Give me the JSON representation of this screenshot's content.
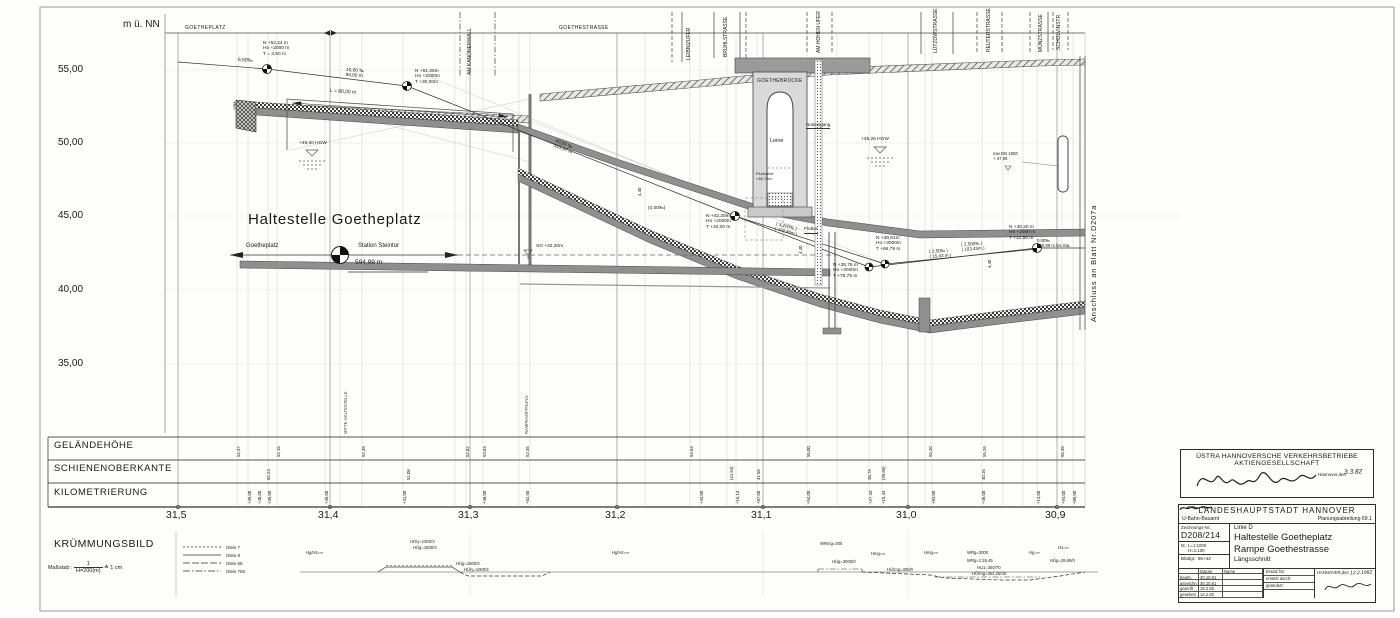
{
  "axis": {
    "unit": "m ü. NN",
    "elevations": [
      "55,00",
      "50,00",
      "45,00",
      "40,00",
      "35,00"
    ],
    "km": [
      "31,5",
      "31,4",
      "31,3",
      "31,2",
      "31,1",
      "31,0",
      "30,9"
    ]
  },
  "rows": {
    "gelaende": "GELÄNDEHÖHE",
    "schienen": "SCHIENENOBERKANTE",
    "kilometrierung": "KILOMETRIERUNG"
  },
  "streets": {
    "goetheplatz": "GOETHEPLATZ",
    "goethestrasse": "GOETHESTRASSE",
    "vertical": [
      {
        "name": "street-am-kanonenwall",
        "label": "AM KANONENWALL",
        "x": 468,
        "y": 75
      },
      {
        "name": "street-leibnizufer",
        "label": "LEIBNIZUFER",
        "x": 687,
        "y": 60
      },
      {
        "name": "street-bruehlstrasse",
        "label": "BRÜHLSTRASSE",
        "x": 724,
        "y": 57
      },
      {
        "name": "street-am-hohen-ufer",
        "label": "AM HOHEN UFER",
        "x": 817,
        "y": 53
      },
      {
        "name": "street-luetzowstrasse",
        "label": "LÜTZOWSTRASSE",
        "x": 934,
        "y": 53
      },
      {
        "name": "street-reuterstrasse",
        "label": "REUTERSTRASSE",
        "x": 987,
        "y": 52
      },
      {
        "name": "street-muenzstrasse",
        "label": "MÜNZSTRASSE",
        "x": 1039,
        "y": 52
      },
      {
        "name": "street-scholvinstr",
        "label": "SCHOLVINSTR.",
        "x": 1057,
        "y": 50
      }
    ]
  },
  "station": {
    "title": "Haltestelle  Goetheplatz",
    "dir_left": "Goetheplatz",
    "dir_right": "Station  Steintor",
    "length": "594,99 m",
    "mitte": "MITTE  HALTESTELLE",
    "rampe": "RAMPENÖFFNUNG"
  },
  "bridge": {
    "name": "GOETHEBRÜCKE",
    "river": "Leine",
    "flusssohle": [
      "Flußsohle",
      "=48,70m"
    ],
    "notausgang": "Notausgang",
    "fluttor": "Fluttor"
  },
  "connection": "Anschluss  an  Blatt  Nr.D207a",
  "annotations": [
    {
      "name": "gradient-point-1",
      "x": 263,
      "y": 41,
      "fs": 4.8,
      "lines": [
        "N  +52,24 m",
        "Ho +2000 m",
        "T  =  3,50 m"
      ]
    },
    {
      "name": "slope-650",
      "x": 238,
      "y": 58,
      "fs": 5,
      "rot": 3,
      "lines": [
        "6,50‰"
      ]
    },
    {
      "name": "slope-1000",
      "x": 346,
      "y": 68,
      "fs": 4.8,
      "rot": 4,
      "lines": [
        "10,00 ‰",
        "94,00 m"
      ]
    },
    {
      "name": "dim-l80",
      "x": 330,
      "y": 89,
      "fs": 5,
      "rot": 4,
      "lines": [
        "L = 80,00 m"
      ]
    },
    {
      "name": "gradient-point-2",
      "x": 415,
      "y": 69,
      "fs": 4.8,
      "lines": [
        "N  +51,30m",
        "Ho +2000m",
        "T  +30,00m"
      ]
    },
    {
      "name": "hgw-left",
      "x": 299,
      "y": 141,
      "fs": 4.8,
      "lines": [
        "+49,00  HGW"
      ]
    },
    {
      "name": "slope-4000",
      "x": 556,
      "y": 139,
      "fs": 4.8,
      "rot": 21,
      "lines": [
        "40,00 ‰",
        "313,97 m"
      ]
    },
    {
      "name": "slope-000-mid",
      "x": 648,
      "y": 206,
      "fs": 4.8,
      "lines": [
        "(0,00‰)"
      ]
    },
    {
      "name": "gradient-point-3",
      "x": 706,
      "y": 214,
      "fs": 4.8,
      "lines": [
        "N  +42,20m",
        "Ho +2000m",
        "T  +32,00 m"
      ]
    },
    {
      "name": "slope-3200",
      "x": 777,
      "y": 221,
      "fs": 4.5,
      "rot": 15,
      "lines": [
        "( 3,200‰ )",
        "( 102,80m )"
      ]
    },
    {
      "name": "so-level",
      "x": 536,
      "y": 244,
      "fs": 4.8,
      "lines": [
        "SO +42,20m"
      ]
    },
    {
      "name": "gradient-point-4",
      "x": 876,
      "y": 236,
      "fs": 4.8,
      "lines": [
        "N  +38,91m",
        "Ho +3000m",
        "T  +66,79 m"
      ]
    },
    {
      "name": "gradient-point-5",
      "x": 833,
      "y": 263,
      "fs": 4.8,
      "lines": [
        "N  +38,76 m",
        "Ho +3000m",
        "T  +76,75 m"
      ]
    },
    {
      "name": "slope-250",
      "x": 929,
      "y": 249,
      "fs": 4.5,
      "rot": -4,
      "lines": [
        "( 2,50‰ )",
        "( 15,43 m )"
      ]
    },
    {
      "name": "slope-2500",
      "x": 961,
      "y": 242,
      "fs": 4.5,
      "rot": -4,
      "lines": [
        "( 2,500‰ )",
        "( 103,43m )"
      ]
    },
    {
      "name": "gradient-point-6",
      "x": 1009,
      "y": 225,
      "fs": 4.8,
      "lines": [
        "N  +40,20 m",
        "Ho +2000 m",
        "T  +12,50 m"
      ]
    },
    {
      "name": "slope-000-right",
      "x": 1037,
      "y": 239,
      "fs": 4.3,
      "lines": [
        "0,00‰",
        "120,89 m bis Sta."
      ]
    },
    {
      "name": "hgw-right",
      "x": 861,
      "y": 137,
      "fs": 4.8,
      "lines": [
        "+49,25  HGW"
      ]
    },
    {
      "name": "pipe-label",
      "x": 993,
      "y": 152,
      "fs": 4.3,
      "lines": [
        "mw DN 1800",
        "+ 47,95"
      ]
    },
    {
      "name": "height-440-a",
      "x": 638,
      "y": 196,
      "fs": 4.3,
      "rot": -90,
      "lines": [
        "4,40"
      ]
    },
    {
      "name": "height-440-b",
      "x": 799,
      "y": 254,
      "fs": 4.3,
      "rot": -90,
      "lines": [
        "4,40"
      ]
    },
    {
      "name": "height-440-c",
      "x": 988,
      "y": 268,
      "fs": 4.3,
      "rot": -90,
      "lines": [
        "4,40"
      ]
    }
  ],
  "ticks": {
    "gelaende": [
      {
        "x": 237,
        "v": "52,37"
      },
      {
        "x": 277,
        "v": "52,15"
      },
      {
        "x": 362,
        "v": "52,48"
      },
      {
        "x": 466,
        "v": "52,82"
      },
      {
        "x": 483,
        "v": "53,04"
      },
      {
        "x": 526,
        "v": "52,35"
      },
      {
        "x": 690,
        "v": "54,64"
      },
      {
        "x": 807,
        "v": "55,00"
      },
      {
        "x": 929,
        "v": "55,20"
      },
      {
        "x": 983,
        "v": "55,26"
      },
      {
        "x": 1061,
        "v": "55,35"
      }
    ],
    "schienen": [
      {
        "x": 267,
        "v": "52,24"
      },
      {
        "x": 407,
        "v": "51,08"
      },
      {
        "x": 730,
        "v": "(41,94)"
      },
      {
        "x": 757,
        "v": "41,55"
      },
      {
        "x": 868,
        "v": "38,79"
      },
      {
        "x": 882,
        "v": "(39,65)"
      },
      {
        "x": 982,
        "v": "40,16"
      }
    ],
    "km": [
      {
        "x": 248,
        "v": "+45,00"
      },
      {
        "x": 258,
        "v": "+40,00"
      },
      {
        "x": 268,
        "v": "+35,00"
      },
      {
        "x": 325,
        "v": "+45,00"
      },
      {
        "x": 403,
        "v": "+41,00"
      },
      {
        "x": 483,
        "v": "+48,00"
      },
      {
        "x": 526,
        "v": "+52,50"
      },
      {
        "x": 700,
        "v": "+44,00"
      },
      {
        "x": 736,
        "v": "+16,13"
      },
      {
        "x": 757,
        "v": "+87,00"
      },
      {
        "x": 807,
        "v": "+54,00"
      },
      {
        "x": 869,
        "v": "+27,43"
      },
      {
        "x": 882,
        "v": "+15,43"
      },
      {
        "x": 932,
        "v": "+83,00"
      },
      {
        "x": 982,
        "v": "+46,00"
      },
      {
        "x": 1037,
        "v": "+13,00"
      },
      {
        "x": 1062,
        "v": "+94,00"
      },
      {
        "x": 1073,
        "v": "+85,00"
      }
    ]
  },
  "kruemmung": {
    "title": "KRÜMMUNGSBILD",
    "massstab_label": "Maßstab :",
    "frac_top": "1",
    "frac_bottom": "H=200(m)",
    "suffix": "≙ 1 cm",
    "legend": [
      {
        "label": "Gleis 7"
      },
      {
        "label": "Gleis 8"
      },
      {
        "label": "Gleis 56"
      },
      {
        "label": "Gleis 756"
      }
    ],
    "labels": [
      {
        "name": "kr-1",
        "x": 410,
        "y": 540,
        "lines": [
          "HÜ/y=1000/3"
        ]
      },
      {
        "name": "kr-2",
        "x": 413,
        "y": 546,
        "lines": [
          "HÜg=1500/3"
        ]
      },
      {
        "name": "kr-3",
        "x": 456,
        "y": 562,
        "lines": [
          "HÜg=1500/3"
        ]
      },
      {
        "name": "kr-4",
        "x": 464,
        "y": 568,
        "lines": [
          "HÜ/y=1000/3"
        ]
      },
      {
        "name": "kr-5",
        "x": 306,
        "y": 551,
        "lines": [
          "Hg/Hz=∞"
        ]
      },
      {
        "name": "kr-6",
        "x": 612,
        "y": 551,
        "lines": [
          "Hg/Hz=∞"
        ]
      },
      {
        "name": "kr-7",
        "x": 820,
        "y": 542,
        "lines": [
          "WRmg=300"
        ]
      },
      {
        "name": "kr-8",
        "x": 832,
        "y": 560,
        "lines": [
          "HÜg=3000/0"
        ]
      },
      {
        "name": "kr-9",
        "x": 871,
        "y": 552,
        "lines": [
          "Hmg=∞"
        ]
      },
      {
        "name": "kr-10",
        "x": 887,
        "y": 568,
        "lines": [
          "HÜ/mg=300/0"
        ]
      },
      {
        "name": "kr-11",
        "x": 924,
        "y": 551,
        "lines": [
          "Hmg=∞"
        ]
      },
      {
        "name": "kr-12",
        "x": 967,
        "y": 551,
        "lines": [
          "WRg=3000"
        ]
      },
      {
        "name": "kr-13",
        "x": 967,
        "y": 559,
        "lines": [
          "WRg=1:26,45"
        ]
      },
      {
        "name": "kr-14",
        "x": 977,
        "y": 566,
        "lines": [
          "HU1=350/70"
        ]
      },
      {
        "name": "kr-15",
        "x": 972,
        "y": 572,
        "lines": [
          "HÜ/mg=354,25/30"
        ]
      },
      {
        "name": "kr-16",
        "x": 1029,
        "y": 551,
        "lines": [
          "Hg=∞"
        ]
      },
      {
        "name": "kr-17",
        "x": 1058,
        "y": 546,
        "lines": [
          "H1=∞"
        ]
      },
      {
        "name": "kr-18",
        "x": 1050,
        "y": 559,
        "lines": [
          "HÜg=29,65/0"
        ]
      }
    ]
  },
  "tb1": {
    "line1": "ÜSTRA HANNOVERSCHE VERKEHRSBETRIEBE",
    "line2": "AKTIENGESELLSCHAFT",
    "city": "Hannover,den",
    "date": "3.3.82"
  },
  "tb2": {
    "title": "LANDESHAUPTSTADT  HANNOVER",
    "office": "U-Bahn-Bauamt",
    "dept": "Planungsabteilung 69.1",
    "zn_label": "Zeichnungs-Nr.:",
    "zn": "D208/214",
    "m_label": "M.:",
    "m1": "L=1:1000",
    "m2": "H=1:100",
    "blatt": "Blattgr.: 95+42",
    "linie": "Linie D",
    "t1": "Haltestelle Goetheplatz",
    "t2": "Rampe Goethestrasse",
    "t3": "Längsschnitt",
    "col_datum": "Datum",
    "col_name": "Name",
    "ersatz": "Ersatz für:",
    "ersetzt": "ersetzt durch:",
    "geaendert": "geändert:",
    "rows": [
      {
        "label": "bearb.",
        "date": "30.10.81"
      },
      {
        "label": "gezeichn.",
        "date": "30.10.81"
      },
      {
        "label": "geprüft",
        "date": "18.2.82"
      },
      {
        "label": "gesehen",
        "date": "12.2.82"
      }
    ],
    "city": "HANNOVER,den",
    "date": "12.2.1982"
  }
}
